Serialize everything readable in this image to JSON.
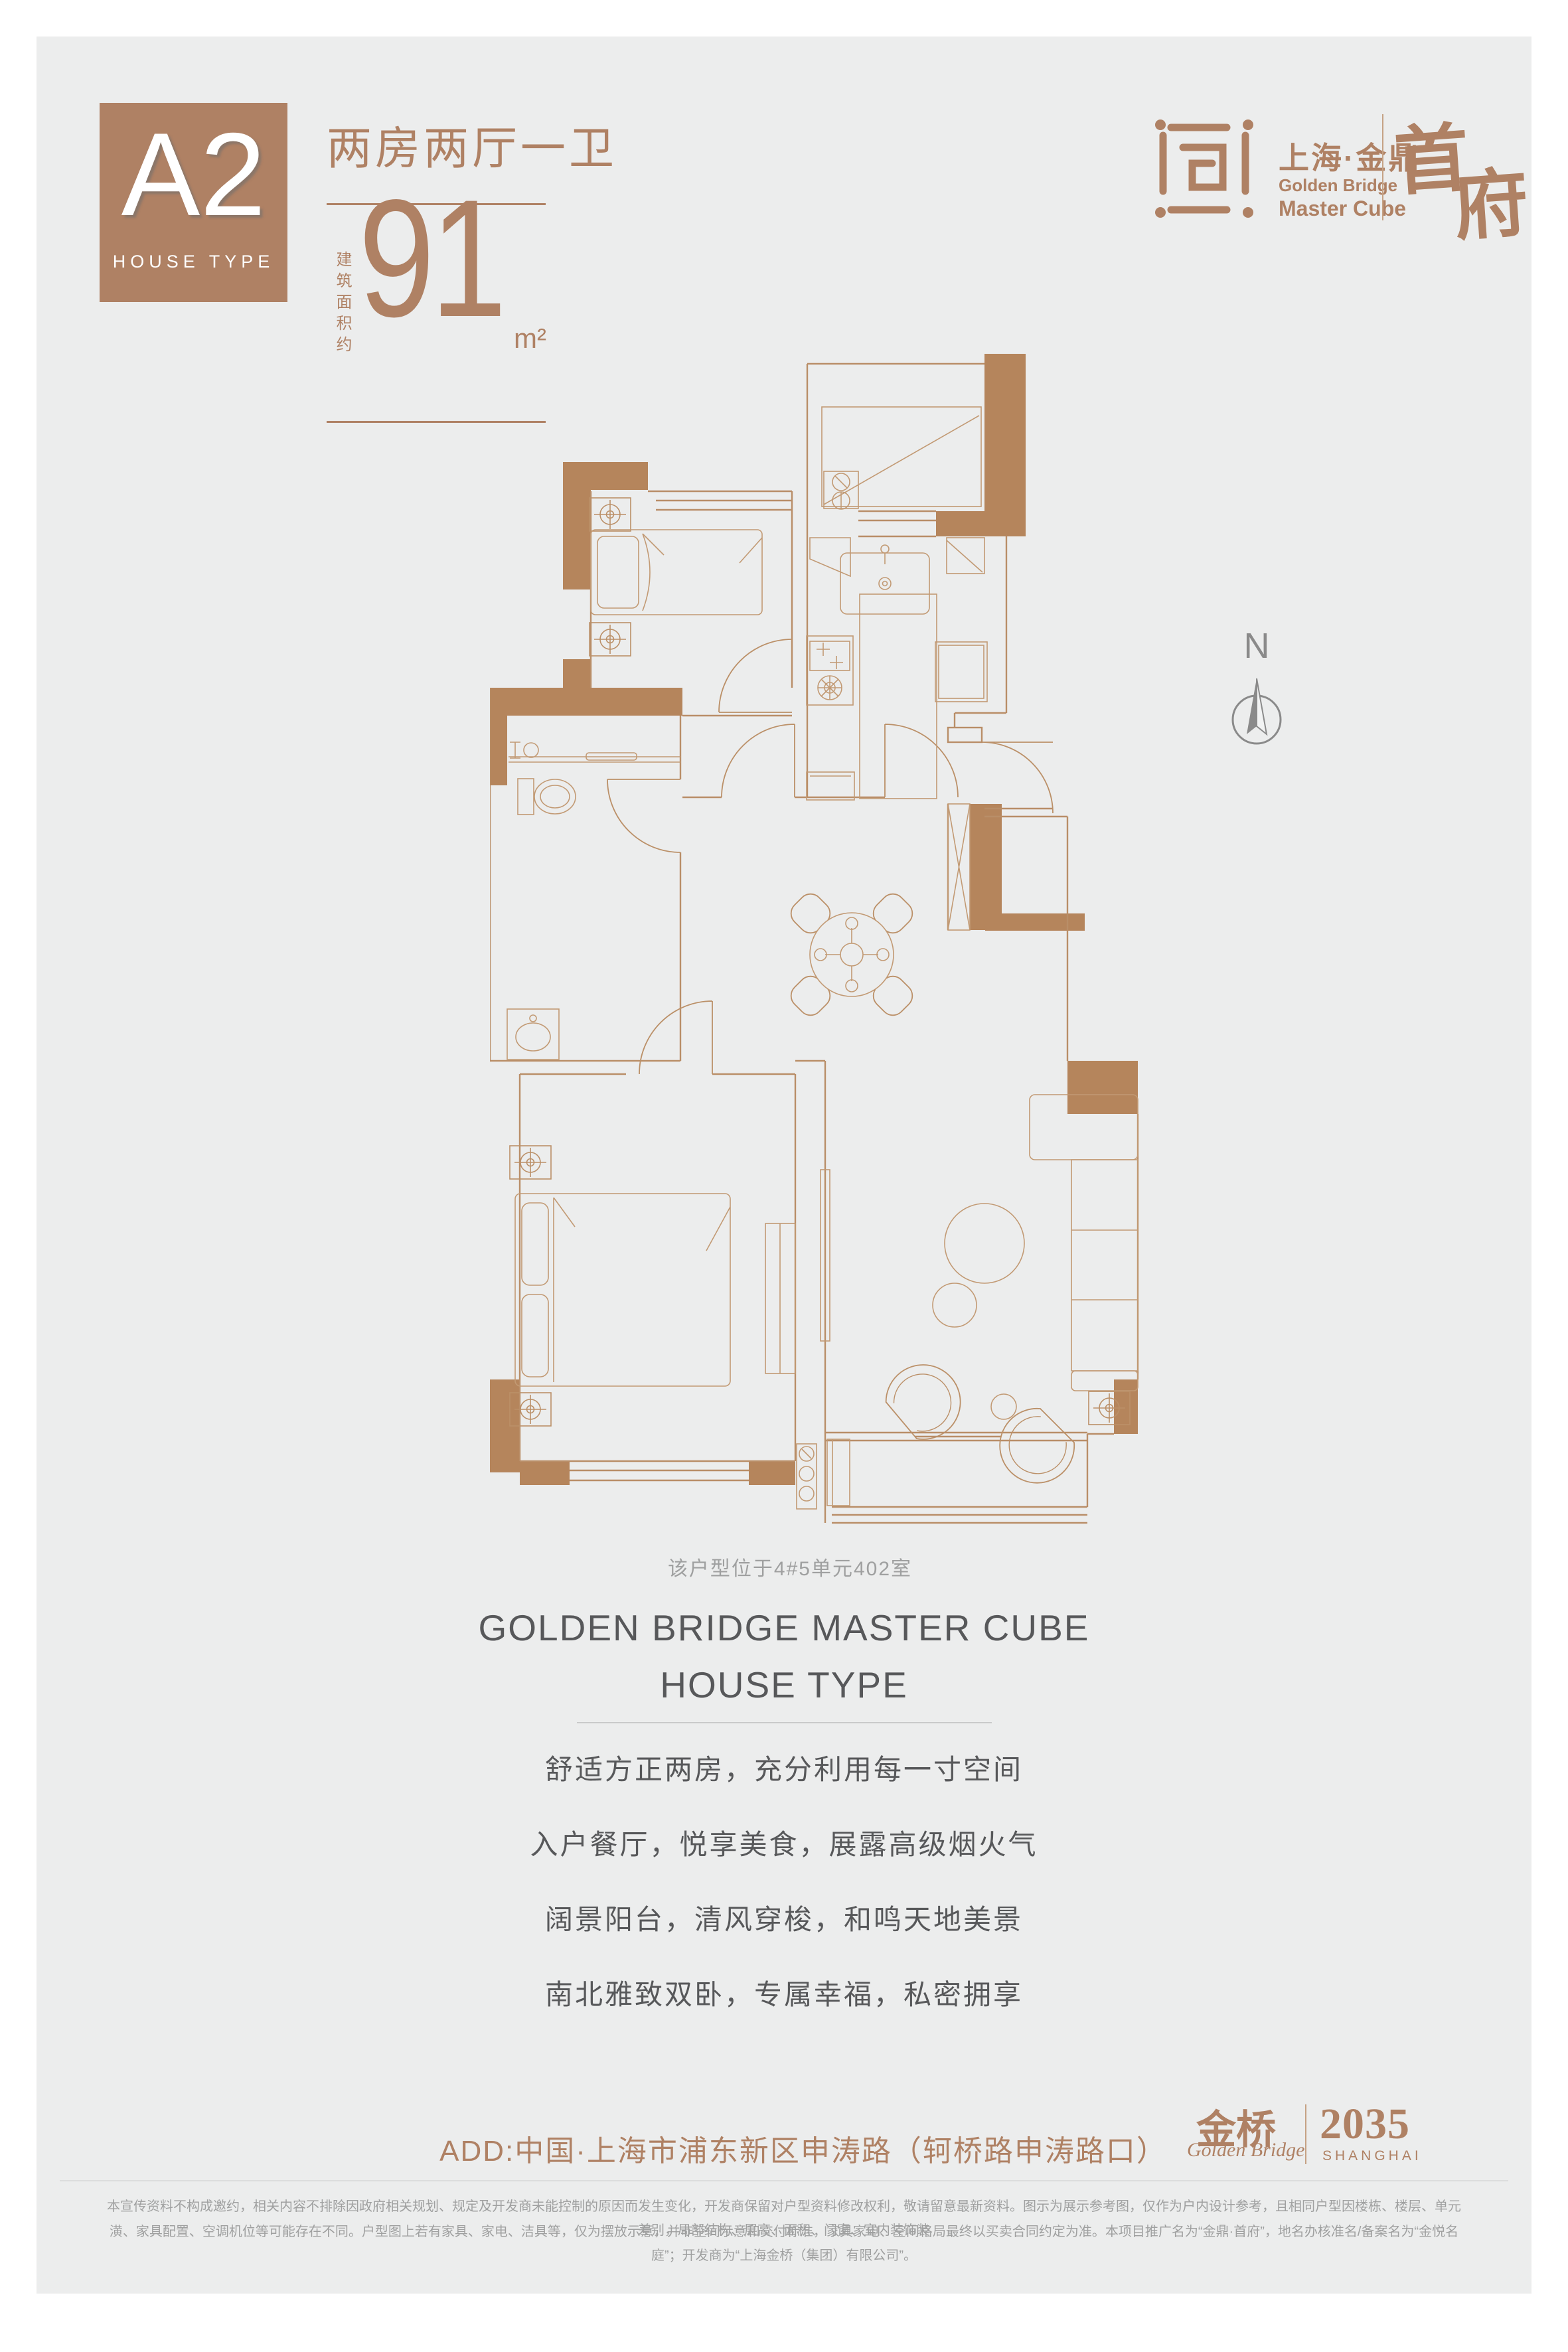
{
  "colors": {
    "panel_bg": "#eceded",
    "accent_brown": "#af8164",
    "wall_brown": "#b5855c",
    "text_gray": "#57585a",
    "caption_gray": "#9fa0a0"
  },
  "header": {
    "type_code": "A2",
    "type_label": "HOUSE TYPE",
    "title": "两房两厅一卫",
    "area_label": "建筑面积约",
    "area_value": "91",
    "area_unit": "m²"
  },
  "brand": {
    "cn": "上海·金鼎",
    "en_line1": "Golden Bridge",
    "en_line2": "Master Cube",
    "seal_char1": "首",
    "seal_char2": "府"
  },
  "compass": {
    "label": "N"
  },
  "plan": {
    "caption": "该户型位于4#5单元402室"
  },
  "section": {
    "heading_line1": "GOLDEN BRIDGE MASTER CUBE",
    "heading_line2": "HOUSE TYPE",
    "lines": [
      "舒适方正两房，充分利用每一寸空间",
      "入户餐厅，悦享美食，展露高级烟火气",
      "阔景阳台，清风穿梭，和鸣天地美景",
      "南北雅致双卧，专属幸福，私密拥享"
    ]
  },
  "address": {
    "text": "ADD:中国·上海市浦东新区申涛路（轲桥路申涛路口）"
  },
  "footer_brand": {
    "cn": "金桥",
    "script": "Golden Bridge",
    "year": "2035",
    "city": "SHANGHAI"
  },
  "disclaimer": {
    "line1": "本宣传资料不构成邀约，相关内容不排除因政府相关规划、规定及开发商未能控制的原因而发生变化，开发商保留对户型资料修改权利，敬请留意最新资料。图示为展示参考图，仅作为户内设计参考，且相同户型因楼栋、楼层、单元差别，局部结构、层高、面积、门窗、室内装饰装",
    "line2": "潢、家具配置、空调机位等可能存在不同。户型图上若有家具、家电、洁具等，仅为摆放示意，并非空间示意和交付标准，家具家电、空间格局最终以买卖合同约定为准。本项目推广名为“金鼎·首府”，地名办核准名/备案名为“金悦名庭”；开发商为“上海金桥（集团）有限公司”。"
  }
}
